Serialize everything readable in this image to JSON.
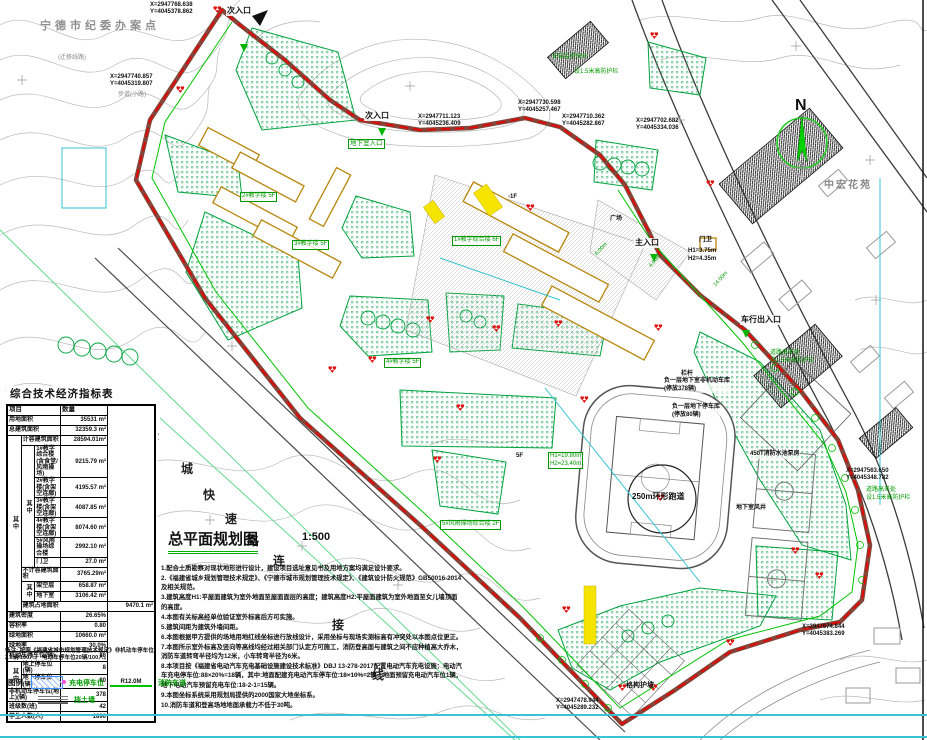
{
  "title_block": {
    "title": "总平面规划图",
    "scale": "1:500"
  },
  "north": {
    "letter": "N"
  },
  "table": {
    "title": "综合技术经济指标表",
    "header": {
      "item": "项目",
      "qty": "数量"
    },
    "merge_label": "其中",
    "rows": [
      {
        "l": "用地面积",
        "v": "35531 m²"
      },
      {
        "l": "总建筑面积",
        "v": "32359.3 m²"
      },
      {
        "l": "计容建筑面积",
        "v": "28594.01m²"
      },
      {
        "l": "1#教学综合楼(含食堂/风雨操场)",
        "v": "9215.79 m²"
      },
      {
        "l": "2#教学楼(含架空连廊)",
        "v": "4195.57 m²"
      },
      {
        "l": "3#教学楼(含架空连廊)",
        "v": "4087.85 m²"
      },
      {
        "l": "4#教学楼(含架空连廊)",
        "v": "8074.60 m²"
      },
      {
        "l": "5#风雨操场综合楼",
        "v": "2992.10 m²"
      },
      {
        "l": "门卫",
        "v": "27.0 m²"
      },
      {
        "l": "不计容建筑面积",
        "v": "3765.29m²"
      },
      {
        "l": "架空层",
        "v": "658.87 m²"
      },
      {
        "l": "地下室",
        "v": "3106.42 m²"
      },
      {
        "l": "建筑占地面积",
        "v": "9470.1 m²"
      },
      {
        "l": "建筑密度",
        "v": "26.65%"
      },
      {
        "l": "容积率",
        "v": "0.80"
      },
      {
        "l": "绿地面积",
        "v": "10660.0 m²"
      },
      {
        "l": "绿地率",
        "v": "30.0%"
      },
      {
        "l": "机动车停车位(辆)",
        "v": "88"
      },
      {
        "l": "地上停车位(辆)",
        "v": "8"
      },
      {
        "l": "地下停车位(辆)",
        "v": "80"
      },
      {
        "l": "非机动车停车位(地上)(辆)",
        "v": "378"
      },
      {
        "l": "班级数(班)",
        "v": "42"
      },
      {
        "l": "学生人数(人)",
        "v": "1890"
      }
    ]
  },
  "remark": "备注: 按照《福建省城市规划管理技术规定》非机动车停车位2.0辆/100人。 电动车停车位20辆/100人。",
  "legend": {
    "caption": "图例",
    "charge": "充电停车位",
    "fire_tag": "R12.0M",
    "fire": "消防车道",
    "wall": "挡土墙"
  },
  "notes": [
    "1.配合土质勘察对现状地形进行设计，建设项目选址意见书及用地方案均满足设计要求。",
    "2.《福建省城乡规划管理技术规定》、《宁德市城市规划管理技术规定》、《建筑设计防火规范》GB50016-2014及相关规范。",
    "3.建筑高度H1:平屋面建筑为室外地面至屋面面层的高度；建筑高度H2:平屋面建筑为室外地面至女儿墙顶面的高度。",
    "4.本图有关标高经单位验证室外标高后方可实施。",
    "5.建筑间距为建筑外墙间距。",
    "6.本图根据甲方提供的场地用地红线坐标进行放线设计，采用坐标与现场实测标高有冲突处以本图点位更正。",
    "7.本图所示室外标高及竖向等高线均经过相关部门认定方可施工，消防登高面与建筑之间不应种植高大乔木，消防车道转弯半径均为12米，小车转弯半径为6米。",
    "8.本项目按《福建省电动汽车充电基础设施建设技术标准》DBJ 13-278-2017配置电动汽车充电设施：电动汽车充电停车位:88×20%=18辆，其中:地面配建充电动汽车停车位:18×10%=2辆，地面预留充电动汽车位1辆，地下电动汽车预留充电车位:18-2-1=15辆。",
    "9.本图坐标系统采用规划局提供的2000国家大地坐标系。",
    "10.消防车道和登高场地地面承载力不低于30吨。"
  ],
  "labels": {
    "site_tl": "宁德市纪委办案点",
    "reloc": "(迁移线路)",
    "path_note": "步道(小路)",
    "entr_n1": "次入口",
    "entr_n2": "次入口",
    "monitor": "安装监控探头",
    "rail1": "设1.5米高防护栏",
    "rail2": "道路高差处\n设1.5米高防护栏",
    "rail3": "道路高差处\n设1.5米高防护栏",
    "basement": "地下室入口",
    "main_entr": "主入口",
    "gate": "门卫",
    "gate_h": "H1=3.75m\nH2=4.35m",
    "veh_entr": "车行出入口",
    "pump": "450T消防水池泵房",
    "vent": "地下室风井",
    "track": "250m环形跑道",
    "garage1": "负一层地下室非机动车库\n(停放378辆)",
    "garage2": "负一层地下停车库\n(停放80辆)",
    "railing": "栏杆",
    "slope": "格构护坡",
    "estate": "中宏花苑",
    "h_label": "H1=19.80m\nH2=23.40m",
    "plaza": "广场",
    "f5": "5F",
    "fm1": "-1F",
    "w6": "6.00m",
    "w4": "4.00m",
    "w14": "14.00m",
    "bl1": "1#教学综合楼 6F",
    "bl2": "2#教学楼 5F",
    "bl3": "3#教学楼 5F",
    "bl4": "4#教学楼 5F",
    "bl5": "5#风雨操场综合楼 2F",
    "c1": "X=2947768.638\nY=4045378.862",
    "c2": "X=2947740.857\nY=4045319.807",
    "c3": "X=2947711.123\nY=4045236.409",
    "c4": "X=2947730.598\nY=4045257.467",
    "c5": "X=2947710.362\nY=4045282.867",
    "c6": "X=2947702.682\nY=4045334.036",
    "c7": "X=2947563.650\nY=4045348.782",
    "c8": "X=2947478.944\nY=4045289.232",
    "c9": "X=2947674.844\nY=4045383.269"
  },
  "road_name": {
    "ch0": "环",
    "ch1": "城",
    "ch2": "快",
    "ch3": "速",
    "ch4": "路",
    "ch5": "连",
    "ch6": "接",
    "ch7": "线"
  },
  "colors": {
    "boundary_red": "#ee0000",
    "fire_lane_road": "#82463a",
    "green_line": "#00c400",
    "green_fill": "#35b06a",
    "cyan": "#35c3d5",
    "yellow": "#f5e400"
  }
}
